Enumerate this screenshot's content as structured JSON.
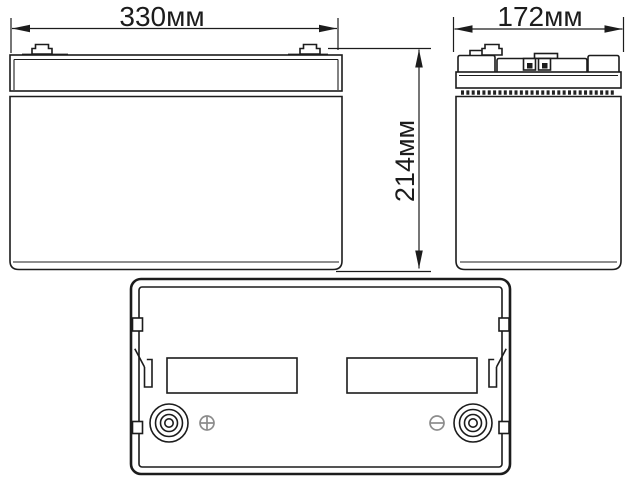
{
  "drawing": {
    "subject": "battery-three-view-technical-drawing",
    "background": "#ffffff",
    "line_color": "#1c1c1c",
    "polarity_symbol_color": "#8c8c8c",
    "dimensions": {
      "width_label": "330мм",
      "depth_label": "172мм",
      "height_label": "214мм"
    },
    "icons": {
      "positive_terminal": "plus-in-circle-icon",
      "negative_terminal": "minus-in-circle-icon"
    }
  }
}
